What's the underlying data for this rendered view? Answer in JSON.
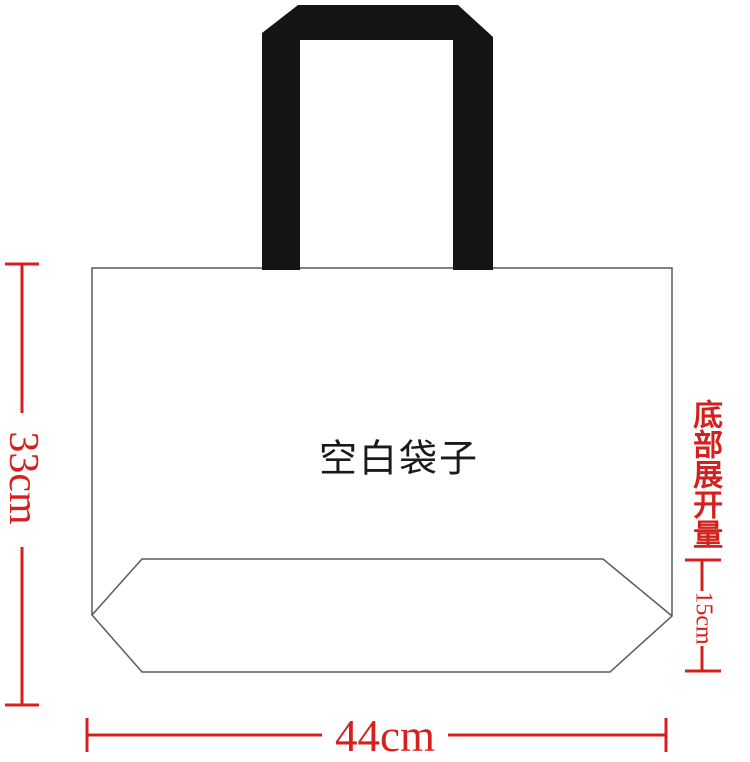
{
  "bag": {
    "label": "空白袋子"
  },
  "dimensions": {
    "height": {
      "value": "33cm"
    },
    "width": {
      "value": "44cm"
    },
    "bottom_expansion": {
      "title": "底部展开量",
      "value": "15cm"
    }
  },
  "colors": {
    "dimension_red": "#d5211d",
    "outline_gray": "#5a5a5a",
    "handle_black": "#141414",
    "label_black": "#1a1a1a"
  }
}
